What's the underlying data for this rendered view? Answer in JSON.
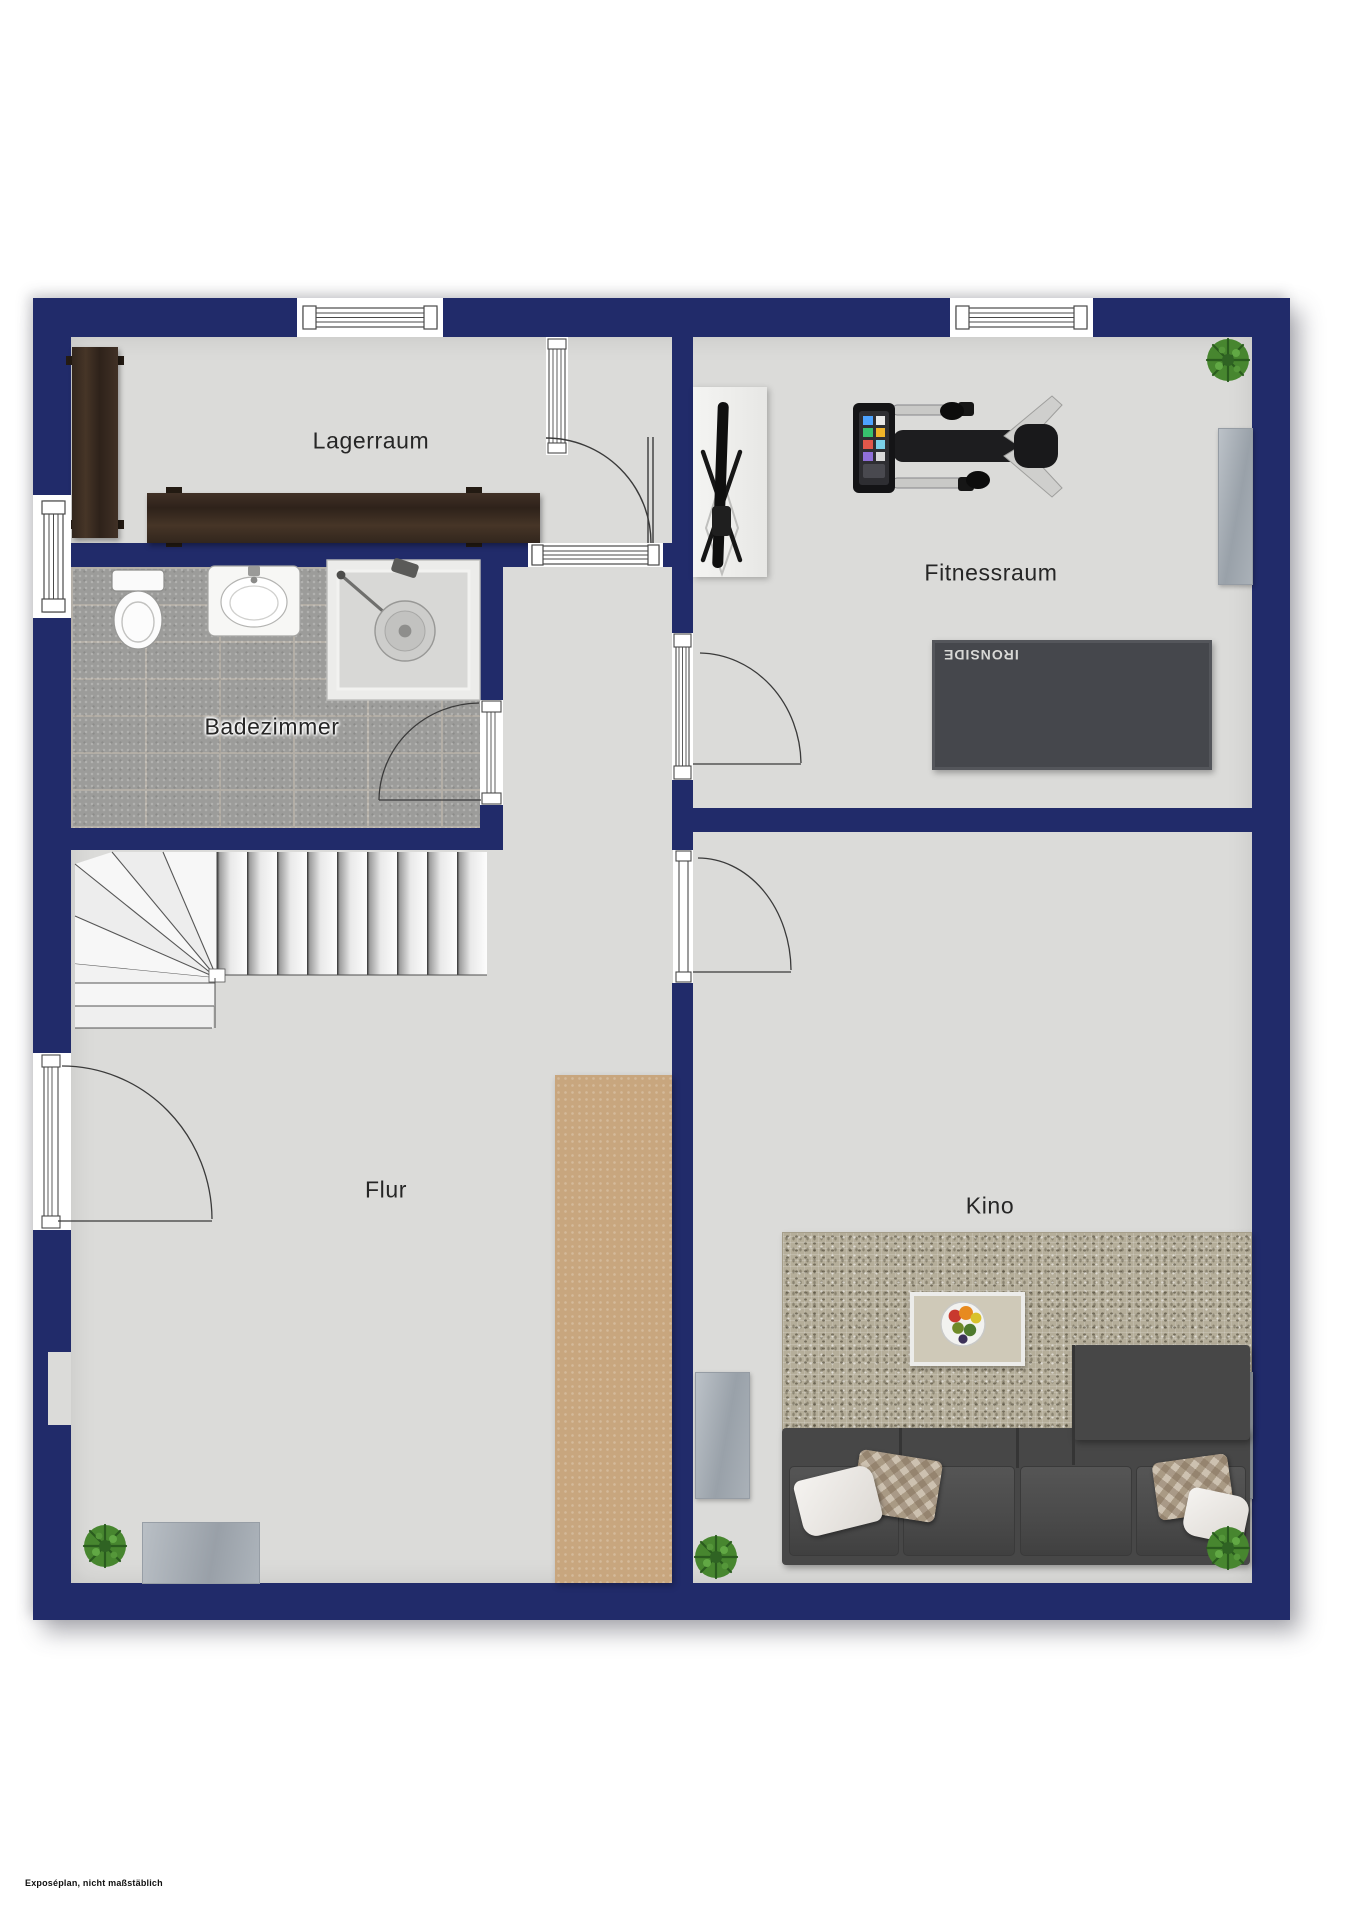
{
  "plan": {
    "type": "floor-plan",
    "disclaimer": "Exposéplan, nicht maßstäblich",
    "rooms": {
      "lagerraum": {
        "label": "Lagerraum"
      },
      "fitnessraum": {
        "label": "Fitnessraum"
      },
      "badezimmer": {
        "label": "Badezimmer"
      },
      "flur": {
        "label": "Flur"
      },
      "kino": {
        "label": "Kino"
      }
    },
    "equipment": {
      "gym_mat_brand": "IRONSIDE"
    },
    "colors": {
      "wall_navy": "#212b6a",
      "floor_gray": "#dbdbd9",
      "tile_gray": "#9c9c9a",
      "gym_mat": "#45474c",
      "runner_tan": "#c8a67e",
      "kino_rug": "#b5ae9a",
      "sofa_gray": "#474747",
      "wood_brown": "#392c22",
      "plant_green": "#47862f"
    }
  }
}
